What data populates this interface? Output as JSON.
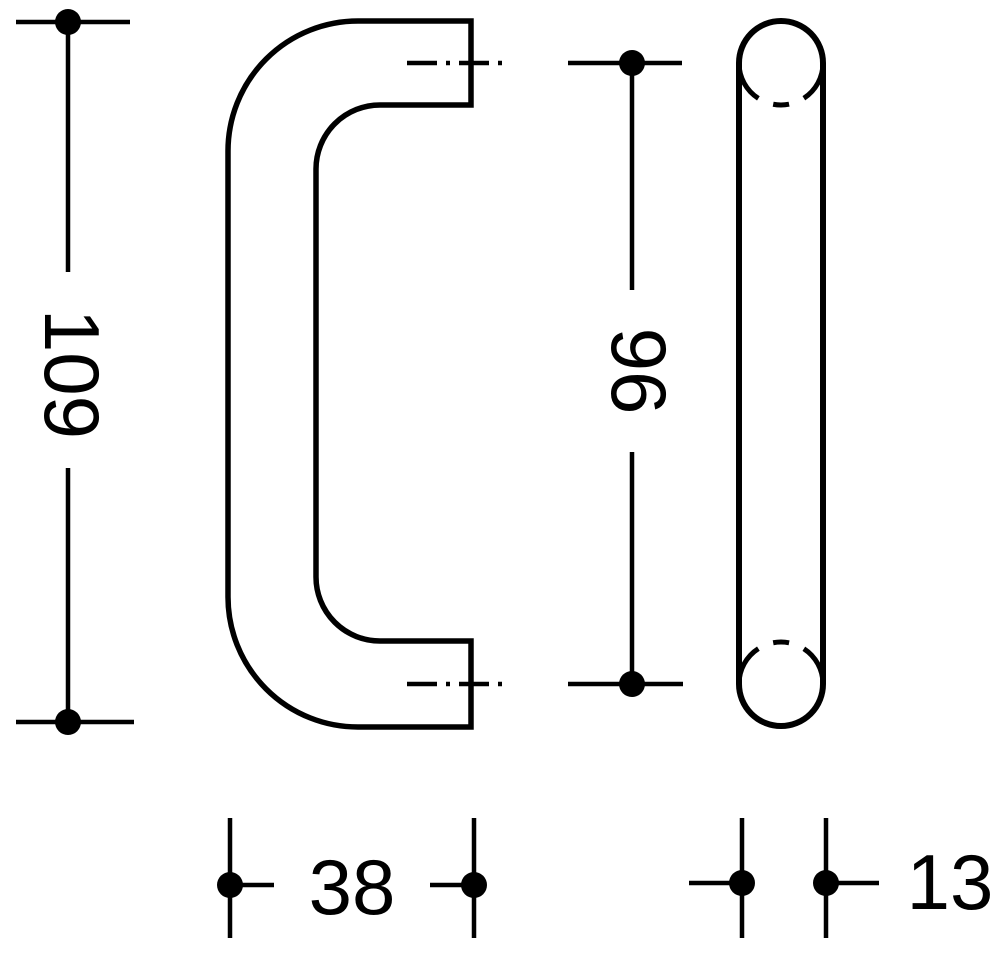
{
  "drawing": {
    "background_color": "#ffffff",
    "line_color": "#000000",
    "dimensions": {
      "overall_length": {
        "value": "109"
      },
      "hole_spacing": {
        "value": "96"
      },
      "grip_depth": {
        "value": "38"
      },
      "tube_diameter": {
        "value": "13"
      }
    }
  }
}
